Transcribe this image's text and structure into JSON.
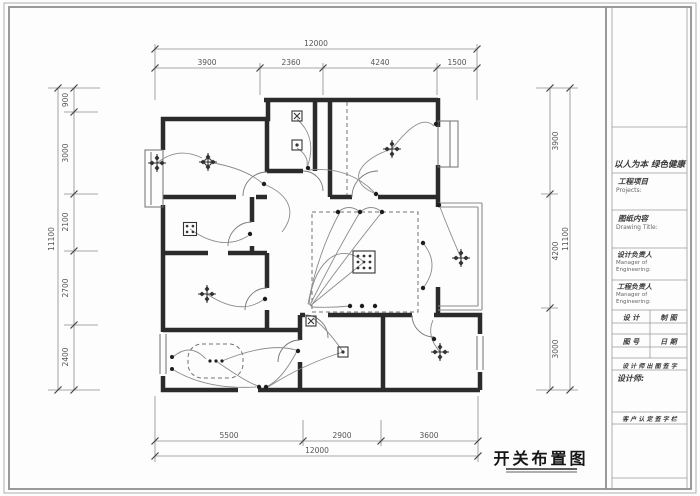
{
  "drawing": {
    "title": "开关布置图"
  },
  "dimensions": {
    "top": {
      "overall": "12000",
      "segments": [
        "3900",
        "2360",
        "4240",
        "1500"
      ]
    },
    "bottom": {
      "overall": "12000",
      "segments": [
        "5500",
        "2900",
        "3600"
      ]
    },
    "left": {
      "overall": "11100",
      "segments": [
        "900",
        "3000",
        "2100",
        "2700",
        "2400"
      ]
    },
    "right": {
      "overall": "11100",
      "segments": [
        "3900",
        "4200",
        "3000"
      ]
    }
  },
  "title_block": {
    "slogan": "以人为本 绿色健康",
    "project_label": "工程项目",
    "project_sub": "Projects:",
    "content_label": "图纸内容",
    "content_sub": "Drawing Title:",
    "design_manager_label": "设计负责人",
    "design_manager_sub1": "Manager of",
    "design_manager_sub2": "Engineering:",
    "project_manager_label": "工程负责人",
    "project_manager_sub1": "Manager of",
    "project_manager_sub2": "Engineering:",
    "cell_design": "设 计",
    "cell_draft": "制 图",
    "cell_sheet_no": "图 号",
    "cell_date": "日 期",
    "seal_row": "设 计 师 出 图 签 字",
    "designer_label": "设计师:",
    "customer_row": "客 户 认 定 签 字 栏"
  },
  "colors": {
    "wall": "#2b2b2b",
    "dim_line": "#8a8a8a",
    "dim_text": "#555555",
    "border": "#9a9a9a"
  }
}
